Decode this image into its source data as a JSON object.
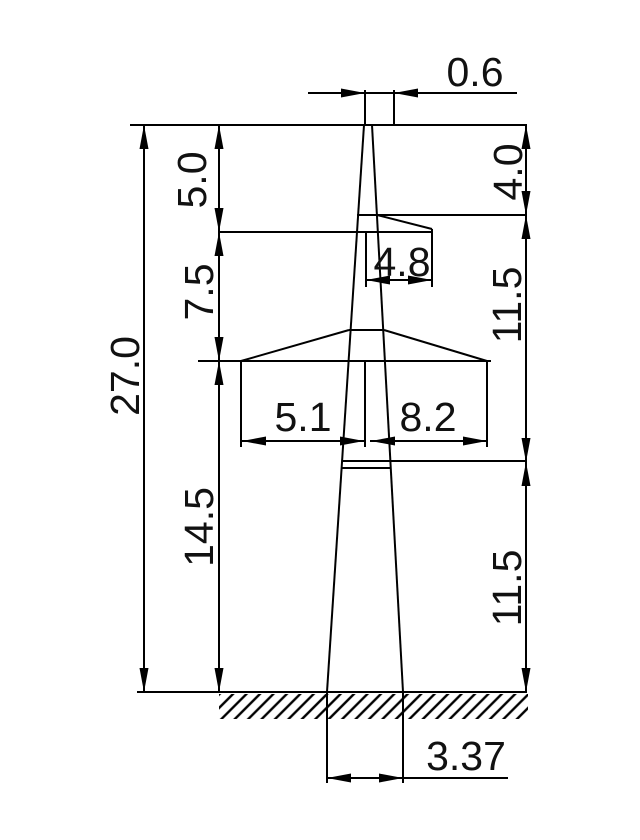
{
  "dimensions": {
    "top_width": "0.6",
    "left_upper": "5.0",
    "left_middle": "7.5",
    "left_lower": "14.5",
    "total_height": "27.0",
    "right_upper": "4.0",
    "right_middle": "11.5",
    "right_lower": "11.5",
    "upper_crossarm": "4.8",
    "lower_crossarm_left": "5.1",
    "lower_crossarm_right": "8.2",
    "base_width": "3.37"
  }
}
